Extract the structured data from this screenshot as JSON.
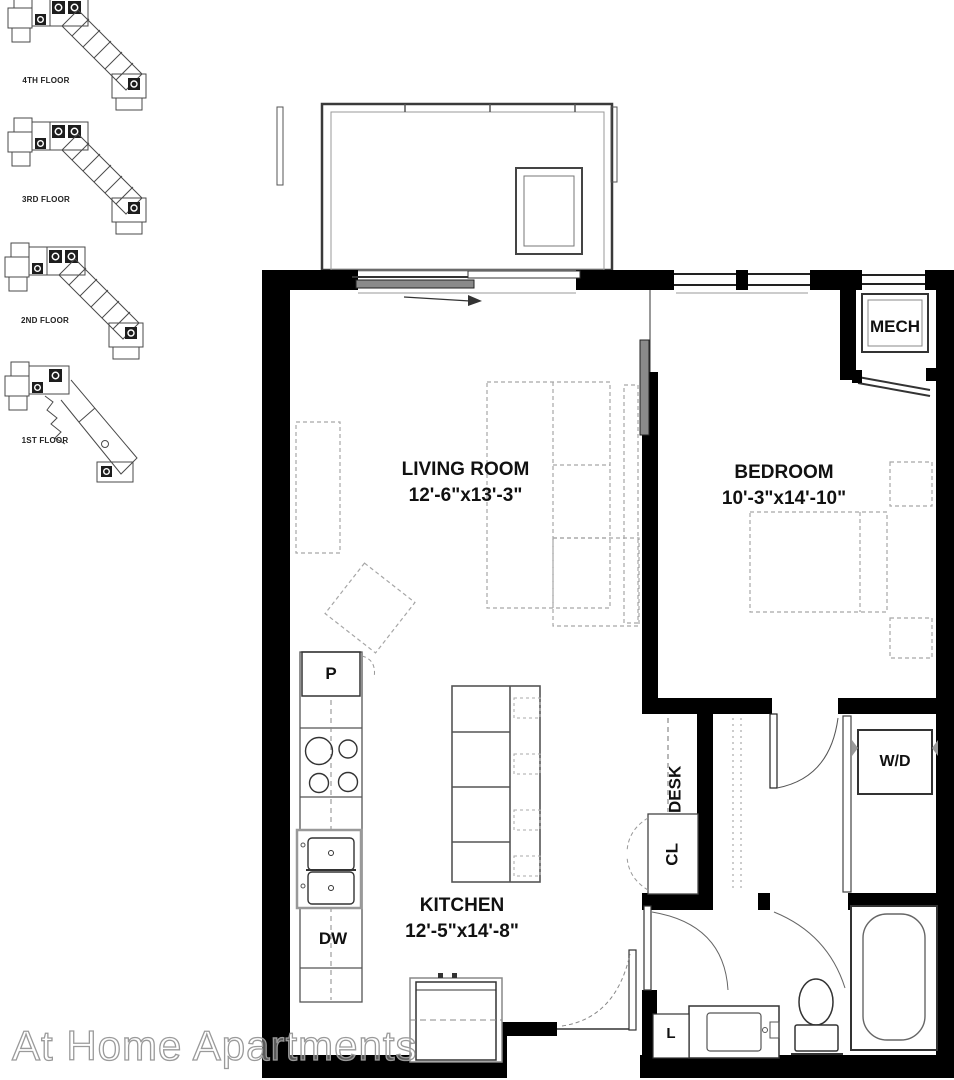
{
  "page": {
    "watermark": "At Home Apartments"
  },
  "floor_locators": [
    {
      "label": "4TH FLOOR"
    },
    {
      "label": "3RD FLOOR"
    },
    {
      "label": "2ND FLOOR"
    },
    {
      "label": "1ST FLOOR"
    }
  ],
  "rooms": {
    "living_room": {
      "label": "LIVING ROOM",
      "dimensions": "12'-6\"x13'-3\""
    },
    "bedroom": {
      "label": "BEDROOM",
      "dimensions": "10'-3\"x14'-10\""
    },
    "kitchen": {
      "label": "KITCHEN",
      "dimensions": "12'-5\"x14'-8\""
    },
    "mech": {
      "label": "MECH"
    }
  },
  "fixtures": {
    "pantry": {
      "label": "P"
    },
    "dishwasher": {
      "label": "DW"
    },
    "desk": {
      "label": "DESK"
    },
    "closet": {
      "label": "CL"
    },
    "washer_dryer": {
      "label": "W/D"
    },
    "linen": {
      "label": "L"
    }
  },
  "colors": {
    "wall": "#000000",
    "line": "#333333",
    "furniture_dash": "#a6a6a6",
    "watermark": "#9a9a9a"
  }
}
